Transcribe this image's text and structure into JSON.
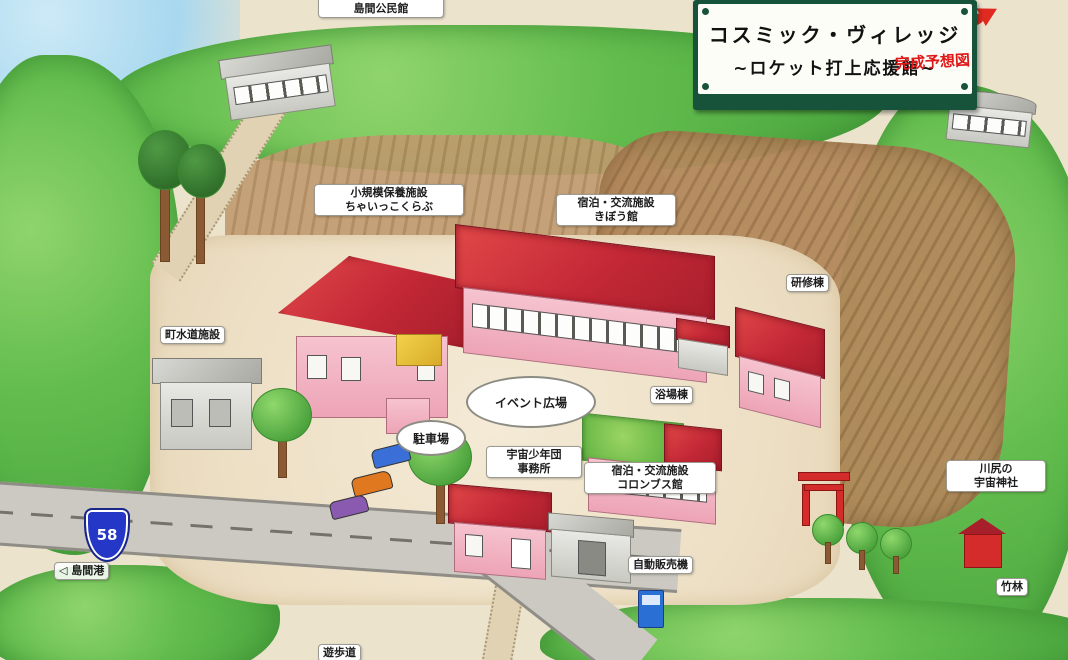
{
  "sign": {
    "title": "コスミック・ヴィレッジ",
    "subtitle": "~ロケット打上応援館~",
    "stamp": "完成予想図"
  },
  "labels": {
    "community_center": {
      "line1": "集会施設",
      "line2": "島間公民館"
    },
    "small_lodge": {
      "line1": "小規模保養施設",
      "line2": "ちゃいっこくらぶ"
    },
    "kibou_hall": {
      "line1": "宿泊・交流施設",
      "line2": "きぼう館"
    },
    "training_bldg": {
      "line1": "研修棟"
    },
    "bath_bldg": {
      "line1": "浴場棟"
    },
    "water_facility": {
      "line1": "町水道施設"
    },
    "event_plaza": {
      "line1": "イベント広場"
    },
    "parking": {
      "line1": "駐車場"
    },
    "youth_office": {
      "line1": "宇宙少年団",
      "line2": "事務所"
    },
    "columbus_hall": {
      "line1": "宿泊・交流施設",
      "line2": "コロンブス館"
    },
    "space_shrine": {
      "line1": "川尻の",
      "line2": "宇宙神社"
    },
    "vending_machine": {
      "line1": "自動販売機"
    },
    "bamboo_grove": {
      "line1": "竹林"
    },
    "promenade": {
      "line1": "遊歩道"
    },
    "port_sign": {
      "line1": "◁ 島間港"
    },
    "route_shield": {
      "number": "58"
    }
  },
  "colors": {
    "roof_red": "#c32836",
    "wall_pink": "#f3b9c6",
    "forest_green": "#63bd4e",
    "field_brown": "#b3895c",
    "road_grey": "#cbc9c2",
    "sign_frame_green": "#17523b",
    "shield_blue": "#2537c6",
    "stamp_red": "#e01818"
  }
}
